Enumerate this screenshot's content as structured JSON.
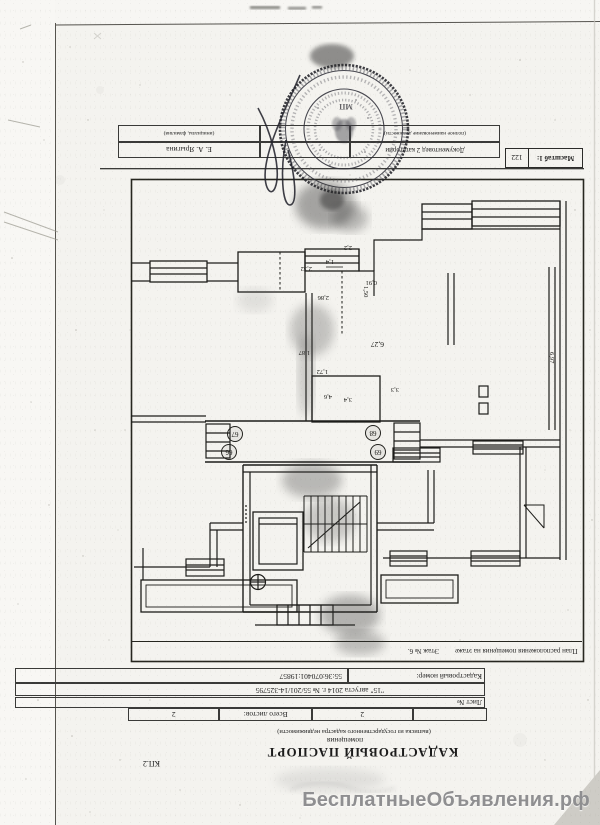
{
  "page": {
    "form_code": "КП.2",
    "title": "КАДАСТРОВЫЙ ПАСПОРТ",
    "subtitle": "помещения",
    "subtitle_note": "(выписка из государственного кадастра недвижимости)",
    "sheet": {
      "label": "Лист №",
      "sheet_value": "2",
      "total_label": "Всего листов:",
      "total_value": "2"
    },
    "doc_line": "\"15\" августа 2014 г. № 55/201/14-325795",
    "cadastral": {
      "label": "Кадастровый номер:",
      "value": "55:36:070401:19857"
    },
    "plan": {
      "caption": "План расположения помещения на этаже",
      "floor": "Этаж № 6.",
      "scale_label": "Масштаб 1:",
      "scale_value": "122",
      "rooms": [
        "67",
        "66",
        "68",
        "69"
      ],
      "dims": {
        "d14": "1,4",
        "d232": "2,32",
        "d22": "2,2",
        "d286": "2,86",
        "d150": "1,50",
        "d091": "0,91",
        "d627": "6,27",
        "d187": "1,87",
        "d172": "1,72",
        "d46": "4,6",
        "d34": "3,4",
        "d33": "3,3",
        "d697": "6,97"
      }
    },
    "signature": {
      "position": "Документовед 2 категории",
      "position_note": "(полное наименование должности)",
      "name": "Е. А. Ярыгина",
      "name_note": "(инициалы, фамилия)",
      "stamp_mark": "МП"
    },
    "watermark": "БесплатныеОбъявления.рф"
  }
}
